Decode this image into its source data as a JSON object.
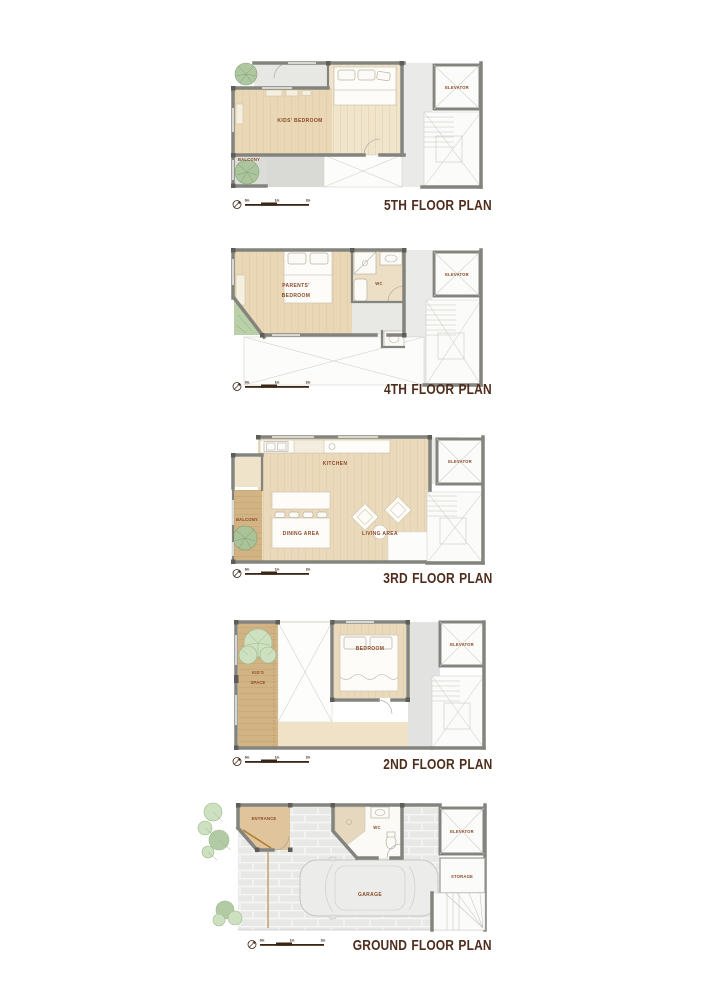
{
  "document": {
    "background": "#ffffff"
  },
  "palette": {
    "wall": "#84847e",
    "wood_floor": "#e9d7b6",
    "wood_floor_light": "#f0e4cb",
    "balcony_wood": "#d2b384",
    "terrace_gray": "#d9d9d5",
    "corridor_gray": "#eaeae8",
    "garage_gray": "#e8e8e6",
    "plant_green": "#a9c49a",
    "plant_green_light": "#cde0c0",
    "room_label_brown": "#8a4a28",
    "title_brown": "#4f2d1c"
  },
  "scale_bar": {
    "labels": [
      "0m",
      "1m",
      "2m"
    ],
    "north_icon": "compass-north"
  },
  "plans": [
    {
      "title": "5TH FLOOR PLAN",
      "rooms": {
        "kids_bedroom": "KIDS' BEDROOM",
        "balcony": "BALCONY",
        "elevator": "ELEVATOR"
      }
    },
    {
      "title": "4TH FLOOR PLAN",
      "rooms": {
        "parents_line1": "PARENTS'",
        "parents_line2": "BEDROOM",
        "wc": "WC",
        "elevator": "ELEVATOR"
      }
    },
    {
      "title": "3RD FLOOR PLAN",
      "rooms": {
        "kitchen": "KITCHEN",
        "balcony": "BALCONY",
        "dining": "DINING AREA",
        "living": "LIVING AREA",
        "elevator": "ELEVATOR"
      }
    },
    {
      "title": "2ND FLOOR PLAN",
      "rooms": {
        "kids_line1": "KID'S",
        "kids_line2": "SPACE",
        "bedroom": "BEDROOM",
        "elevator": "ELEVATOR"
      }
    },
    {
      "title": "GROUND FLOOR PLAN",
      "rooms": {
        "entrance": "ENTRANCE",
        "wc": "WC",
        "garage": "GARAGE",
        "storage": "STORAGE",
        "elevator": "ELEVATOR"
      }
    }
  ]
}
